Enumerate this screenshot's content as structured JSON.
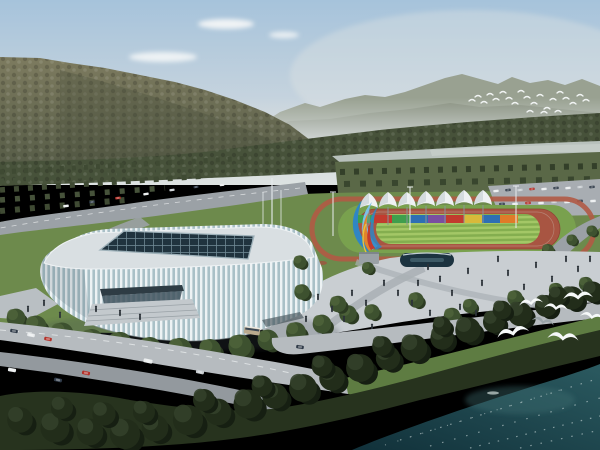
{
  "scene": {
    "type": "architectural-aerial-rendering",
    "description": "Aerial architectural rendering of a white ribbed glass sports arena with a dark gridded skylight roof, next to an outdoor athletics track with a row of white peaked canopy tents and a rainbow panel wall, a colorful ribbon sculpture on a plaza with pedestrians and trees, a parking lot with cars, roads with traffic, forested mountains and a pale river behind, and a dark teal lake with white gulls flying over shoreline trees in the foreground.",
    "elements": [
      {
        "name": "sky",
        "description": "pale hazy blue sky with a few small white clouds upper left"
      },
      {
        "name": "left-mountain",
        "description": "large olive-green forested ridge sloping down from top left"
      },
      {
        "name": "far-mountain-range",
        "description": "hazy gray-green mountain range across the right horizon"
      },
      {
        "name": "distant-bird-flock",
        "description": "small flock of white birds in front of the far mountains"
      },
      {
        "name": "river",
        "description": "pale gray-green river band on the right middle distance"
      },
      {
        "name": "forest-band",
        "description": "dark green tree belts and orchard rows in the middle distance"
      },
      {
        "name": "highway",
        "description": "curving gray highway with small cars, upper left"
      },
      {
        "name": "arena",
        "description": "white arena with vertical fin facade, teal glass, gray roof, dark glass grid skylight, entrance canopy and stairs"
      },
      {
        "name": "athletics-track",
        "description": "red-brown running track around a striped green infield with outer red jogging loop"
      },
      {
        "name": "canopy-tents",
        "description": "row of white peaked tents on poles behind the track"
      },
      {
        "name": "rainbow-panel-wall",
        "description": "multicolored panel wall along the far side of the track"
      },
      {
        "name": "ribbon-sculpture",
        "description": "abstract blue, orange and red ribbon sculpture on a gray pedestal"
      },
      {
        "name": "flagpoles-and-floodlights",
        "description": "thin poles and floodlight masts around the track"
      },
      {
        "name": "parking-lot",
        "description": "parking area with rows of cars, upper right"
      },
      {
        "name": "plaza",
        "description": "light gray pedestrian plaza with walkways, trees, a dark reflecting pool and many tiny pedestrians"
      },
      {
        "name": "front-roads",
        "description": "diagonal roads with cars and a tan bus in the lower left"
      },
      {
        "name": "shoreline-trees",
        "description": "dense dark green trees and grass along the waterfront"
      },
      {
        "name": "lake",
        "description": "dark teal water with light foam flecks filling the lower right corner"
      },
      {
        "name": "gulls",
        "description": "seven large white gulls flying over the shoreline trees, lower right"
      }
    ],
    "counts": {
      "canopy_tents": 7,
      "rainbow_panels": 9,
      "large_gulls": 7,
      "distant_flock_birds": 22
    }
  },
  "palette": {
    "sky-top": "#a6c3db",
    "sky-mid": "#c9d5de",
    "sky-low": "#dde2e1",
    "cloud": "#f3f6f7",
    "mtn-far": "#99a191",
    "mtn-far2": "#868e7d",
    "mtn-top": "#7d7b5f",
    "mtn-bot": "#565c47",
    "forest": "#47523a",
    "river": "#b8c1bc",
    "lawn": "#6d8a4c",
    "grass": "#5e7c42",
    "road": "#9ba1a6",
    "road-light": "#b6bbbf",
    "plaza": "#c9ced2",
    "track-red": "#a85542",
    "loop-red": "#b05a45",
    "ring-green": "#79a14e",
    "field-light": "#a3c766",
    "field-dark": "#84ae4f",
    "tent": "#eef1f3",
    "panel-red": "#c23b2e",
    "panel-green": "#3f9e4d",
    "panel-blue": "#2e6fb3",
    "panel-purple": "#7a4fa0",
    "panel-yellow": "#d9b93a",
    "panel-orange": "#e07b28",
    "sculpture-blue": "#2f86c4",
    "sculpture-cyan": "#7cc0e8",
    "sculpture-orange": "#e0832c",
    "sculpture-red": "#c23b2e",
    "fin": "#edf2f4",
    "glass": "#a9c0c7",
    "roof": "#d9dfe2",
    "skylight": "#20333e",
    "skylight-grid": "#6f8894",
    "shore-tree": "#27331e",
    "water-deep": "#11313a",
    "water-light": "#2b5a60",
    "foam": "#dce8e7",
    "bird": "#f6f9f9",
    "car-white": "#e9eced",
    "car-red": "#b33028",
    "car-dark": "#2f3a48",
    "people": "#2c3339"
  }
}
